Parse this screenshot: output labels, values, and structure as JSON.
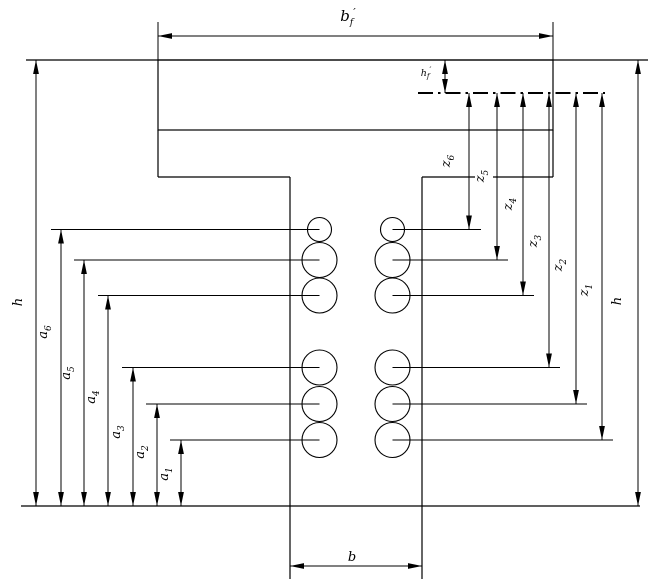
{
  "figure": {
    "description": "T-beam cross-section with flange hatching, two columns of reinforcement bars, bottom-up distances a1-a6, lever arms z1-z6 from flange centroid line, overall height h and widths bf', b",
    "colors": {
      "line": "#000000",
      "background": "#ffffff"
    },
    "rebar": {
      "columns": 2,
      "rows": 6
    },
    "dims": {
      "bf": {
        "base": "b",
        "sub": "f",
        "prime": "′"
      },
      "hf": {
        "base": "h",
        "sub": "f",
        "prime": "′"
      },
      "b": {
        "base": "b"
      },
      "h_left": {
        "base": "h"
      },
      "h_right": {
        "base": "h"
      },
      "a": [
        {
          "base": "a",
          "sub": "1"
        },
        {
          "base": "a",
          "sub": "2"
        },
        {
          "base": "a",
          "sub": "3"
        },
        {
          "base": "a",
          "sub": "4"
        },
        {
          "base": "a",
          "sub": "5"
        },
        {
          "base": "a",
          "sub": "6"
        }
      ],
      "z": [
        {
          "base": "z",
          "sub": "1"
        },
        {
          "base": "z",
          "sub": "2"
        },
        {
          "base": "z",
          "sub": "3"
        },
        {
          "base": "z",
          "sub": "4"
        },
        {
          "base": "z",
          "sub": "5"
        },
        {
          "base": "z",
          "sub": "6"
        }
      ]
    }
  }
}
